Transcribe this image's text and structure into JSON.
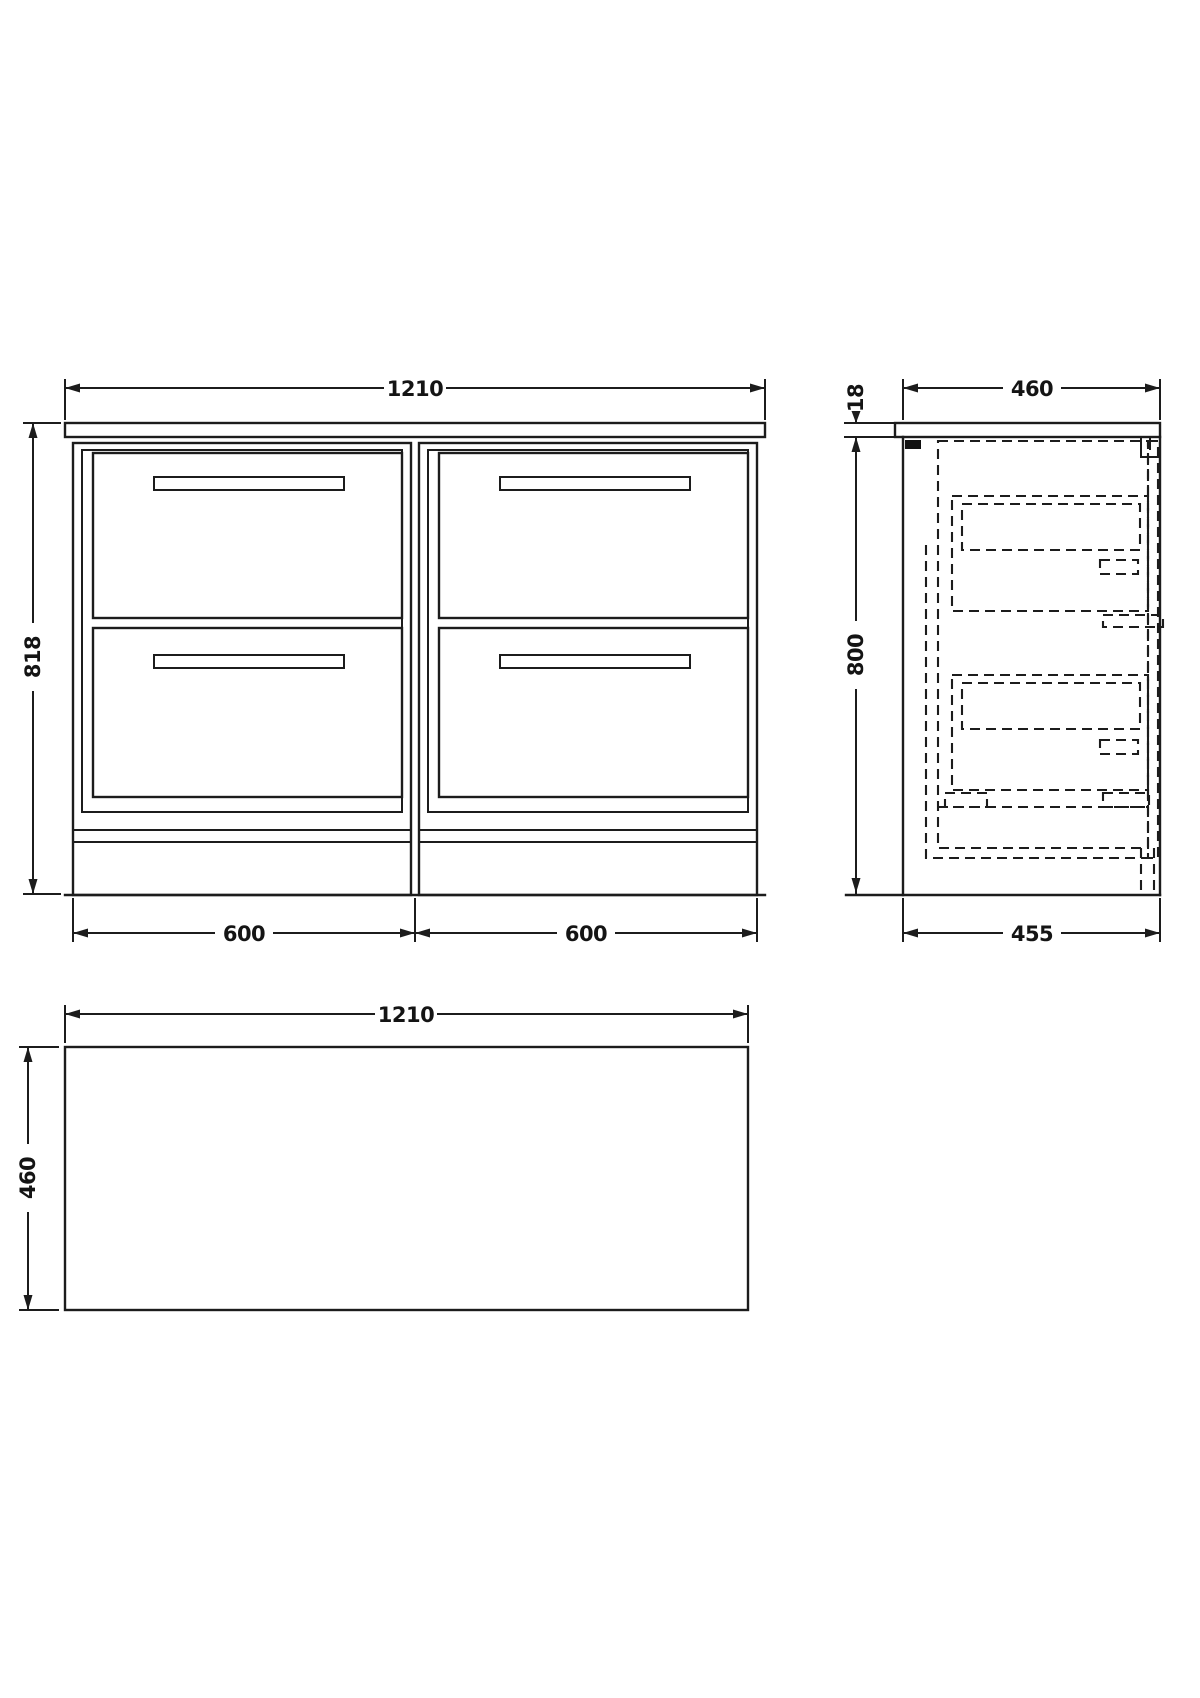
{
  "drawing": {
    "kind": "furniture-dimension-drawing",
    "views": {
      "front_elevation": {
        "width_mm": "1210",
        "height_mm": "818",
        "left_unit_mm": "600",
        "right_unit_mm": "600"
      },
      "side_elevation": {
        "worktop_depth_mm": "460",
        "worktop_thickness_mm": "18",
        "cabinet_height_mm": "800",
        "cabinet_depth_mm": "455"
      },
      "plan_view": {
        "width_mm": "1210",
        "depth_mm": "460"
      }
    },
    "style": {
      "line_color": "#1c1c1c",
      "background": "#ffffff"
    }
  }
}
